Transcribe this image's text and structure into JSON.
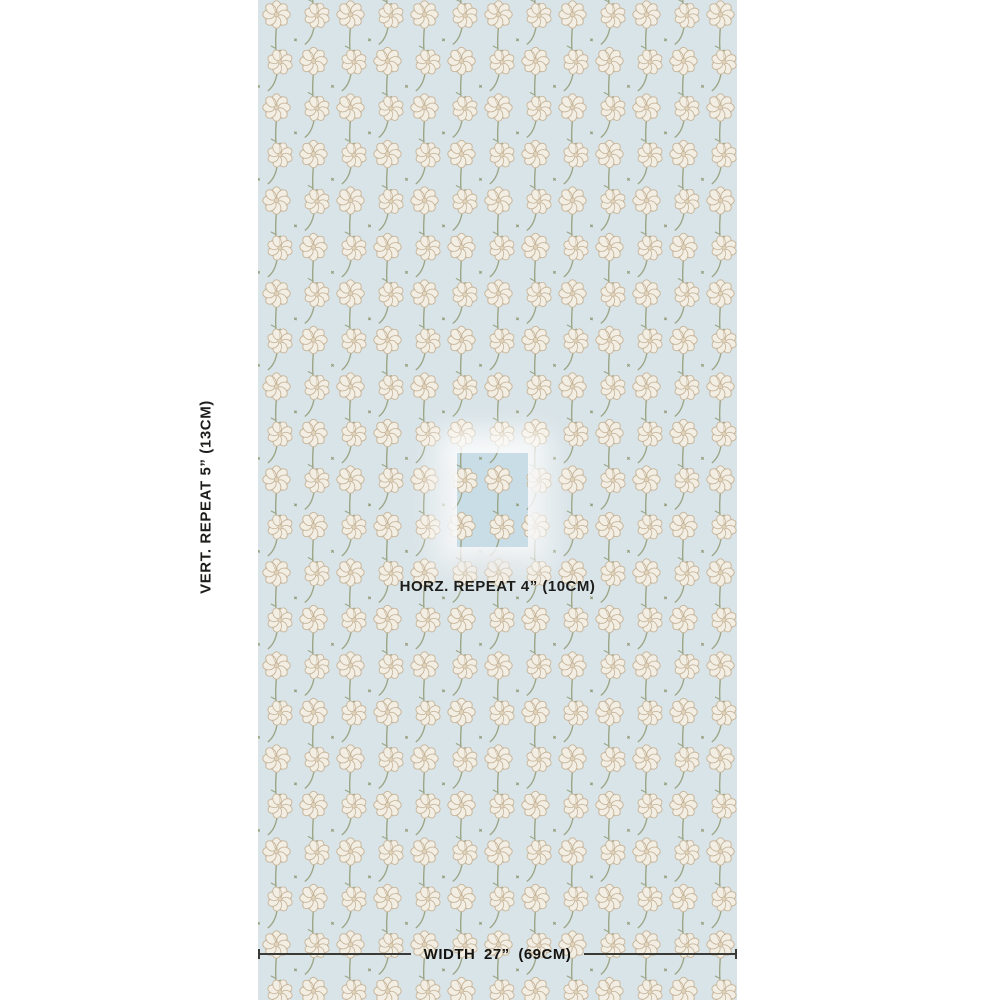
{
  "page_background": "#ffffff",
  "labels": {
    "vertical_repeat": "VERT. REPEAT 5” (13CM)",
    "horizontal_repeat": "HORZ. REPEAT 4” (10CM)",
    "width": "WIDTH 27” (69CM)"
  },
  "text_color": "#1d1d1b",
  "pattern": {
    "fabric_background": "#d9e4e8",
    "petal": "#f3eee3",
    "petal_outline": "#c6b499",
    "flower_center": "#ded2ba",
    "stem": "#9ca586",
    "accent": "#8e9770"
  },
  "highlight": {
    "background": "#c9dde6",
    "glow_color": "#ffffff",
    "shadow_color": "rgba(96,108,118,0.45)"
  },
  "measure": {
    "line_color": "#3a3a36"
  }
}
